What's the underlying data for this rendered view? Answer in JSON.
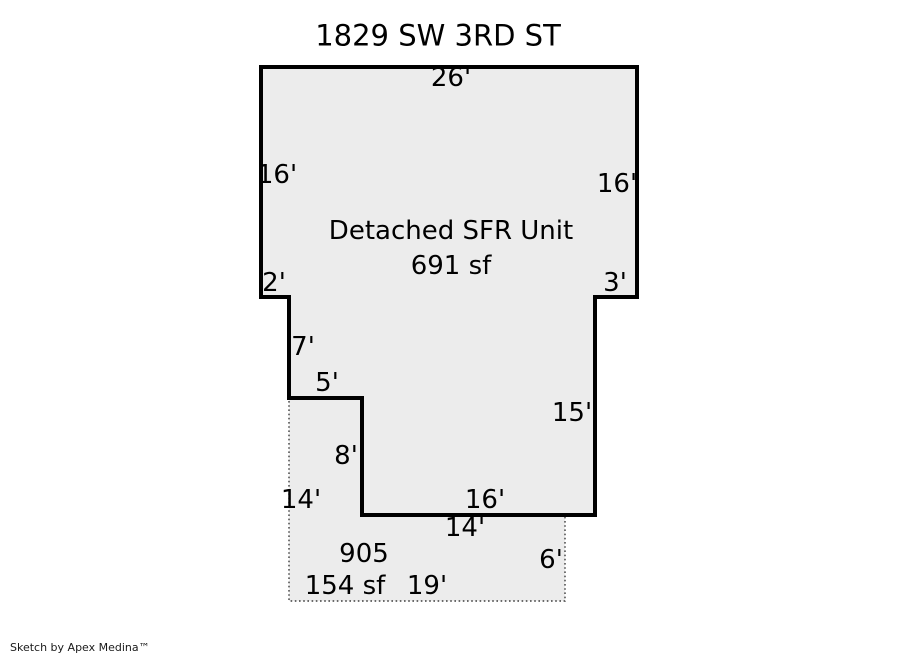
{
  "title": "1829 SW 3RD ST",
  "footer": "Sketch by Apex Medina™",
  "colors": {
    "background": "#ffffff",
    "shape_fill": "#ececec",
    "solid_outline": "#000000",
    "dashed_outline": "#3c3c3c",
    "text": "#000000"
  },
  "main_unit": {
    "name": "Detached SFR Unit",
    "area": "691 sf",
    "dims": {
      "top": "26'",
      "left_upper": "16'",
      "right_upper": "16'",
      "left_step": "2'",
      "right_step": "3'",
      "left_mid": "7'",
      "inset_top": "5'",
      "inset_side": "8'",
      "bottom": "16'",
      "right_lower": "15'"
    }
  },
  "attached_area": {
    "name": "905",
    "area": "154 sf",
    "dims": {
      "top": "14'",
      "left": "14'",
      "right": "6'",
      "bottom": "19'"
    }
  }
}
